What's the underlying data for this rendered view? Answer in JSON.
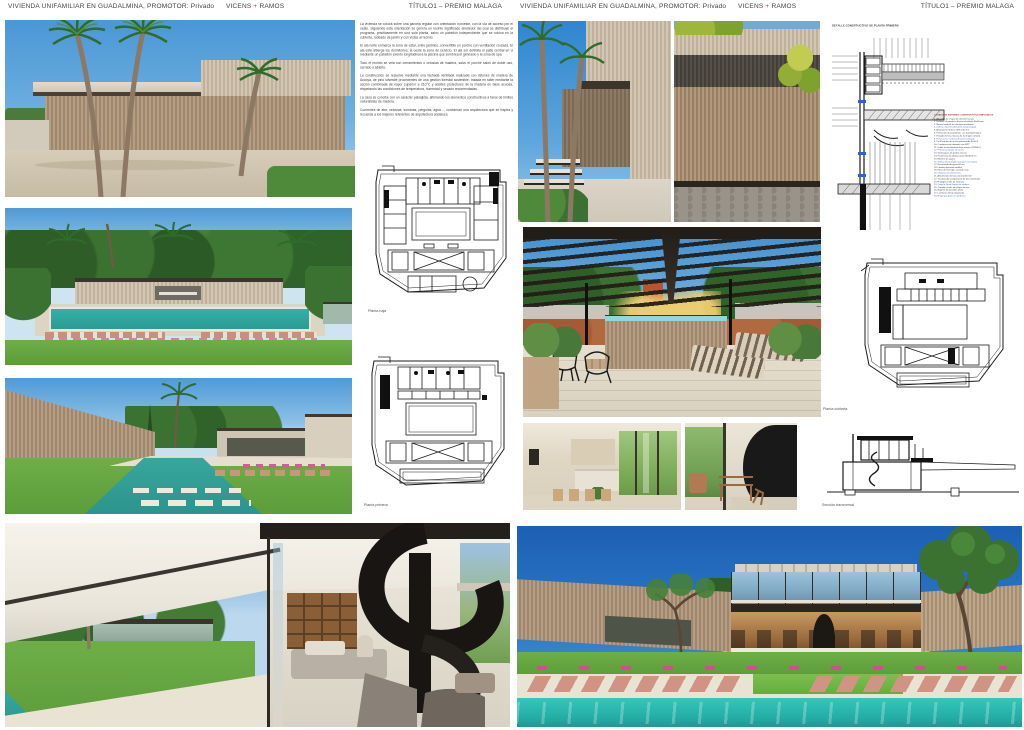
{
  "palette": {
    "accent_red": "#e0301e",
    "header_text": "#424242",
    "drawing_ink": "#1c1c1c",
    "pool_teal": "#2fb3ab",
    "sky_blue": "#4a97d6",
    "timber": "#b59e83"
  },
  "header": {
    "project": "VIVIENDA UNIFAMILIAR EN GUADALMINA,  PROMOTOR: Privado",
    "firm_a": "VICENS",
    "firm_plus": "+",
    "firm_b": "RAMOS",
    "award": "TÍTULO1 – PREMIO MALAGA"
  },
  "memoria": {
    "paragraphs": [
      "La vivienda se coloca sobre una parcela regular con orientación noroeste, con la vía de acceso por el oeste. Siguiendo esta orientación se genera un recinto significado alrededor del cual se distribuye el programa, prácticamente en una sola planta, salvo un pabellón independiente que se coloca en la cubierta, rodeado de jardín y con vistas al recinto.",
      "El ala norte enmarca la zona de estar, entre jardines, convertible en porche con ventilación cruzada. El ala este alberga los dormitorios, la oeste la zona de servicio. El ala sur delimita el patio central en U mediante un pabellón exento longitudinal a la piscina que sombrea el gimnasio y la zona de spa.",
      "Todo el recinto se vela con cerramientos o celosías de madera, salvo el porche salón de doble uso, cerrado o abierto.",
      "La construcción se resuelve mediante una fachada ventilada realizada con listones de madera de Accoya, de pino silvestre procedentes de una gestión forestal sostenible, tratada en taller mediante la acción combinada de vapor superior a 210°C y aceites protectores de la madera en base acuosa, respetando las condiciones de temperatura, humedad y secado recomendadas.",
      "La casa se concibe con un carácter paisajista, afirmando los elementos constructivos a favor de límites naturalistas de madera.",
      "Corrientes de aire, celosías, sombras, pérgolas, agua…, conforman una arquitectura que se inspira y recuerda a los mejores referentes de arquitectura andaluza."
    ]
  },
  "captions": {
    "planta_baja": "Planta baja",
    "planta_primera": "Planta primera",
    "planta_cubierta": "Planta cubierta",
    "seccion_transversal": "Sección transversal"
  },
  "detail": {
    "title": "DETALLE CONSTRUCTIVO DE PLANTA PRIMERA",
    "legend_title": "LISTADO DE SISTEMAS CONSTRUCTIVOS EMPLEADOS",
    "legend_items": [
      "1. Albardilla de chapa de aluminio lacado",
      "2. Listones de madera de pino acetilada 40x60 mm",
      "3. Rastrel vertical de aluminio anodizado",
      "4. Lámina impermeabilizante autoprotegida",
      "5. Aislamiento térmico XPS 100 mm",
      "6. Formación de pendientes con hormigón ligero",
      "7. Forjado de losa maciza de hormigón armado",
      "8. Falso techo continuo de yeso laminado",
      "9. Perfil tubular de acero galvanizado 60.40.3",
      "10. Carpintería de aluminio con RPT",
      "11. Doble acristalamiento bajo emisivo 8/16/6+6",
      "12. Premarco tubular de acero",
      "13. Vierteaguas de piedra natural",
      "14. Pavimento de piedra caliza 60x40x3 cm",
      "15. Mortero de agarre",
      "16. Solera de hormigón armado con mallazo",
      "17. Encachado de grava 20 cm",
      "18. Lámina drenante nodular",
      "19. Muro de hormigón armado visto",
      "20. Imprimación bituminosa",
      "21. Aislamiento de lana mineral 60 mm",
      "22. Trasdosado autoportante de yeso laminado",
      "23. Rodapié oculto de aluminio",
      "24. Celosía fija de lamas de madera",
      "25. Canalón oculto de chapa de zinc",
      "26. Bajante de pluviales Ø110",
      "27. Luminaria lineal empotrada",
      "28. Riego por goteo en jardinera"
    ]
  }
}
